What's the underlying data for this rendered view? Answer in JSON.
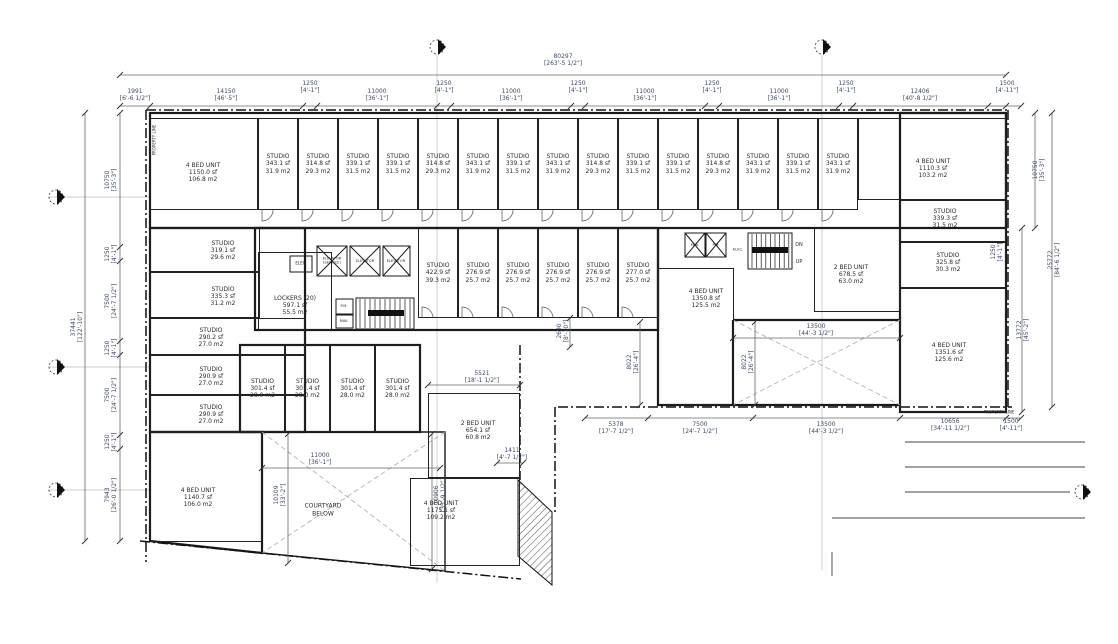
{
  "drawing": {
    "type": "architectural-floor-plan",
    "colors": {
      "wall": "#1a1a1a",
      "dim_text": "#3d4a63",
      "room_text": "#2b2b2b",
      "background": "#ffffff",
      "hatch": "#555555"
    }
  },
  "rooms": [
    {
      "n": "4 BED UNIT",
      "sf": "1150.0 sf",
      "m2": "106.8 m2",
      "x": 150,
      "y": 118,
      "w": 108,
      "h": 92,
      "lx": 202,
      "ly": 172
    },
    {
      "n": "STUDIO",
      "sf": "343.1 sf",
      "m2": "31.9 m2",
      "x": 258,
      "y": 118,
      "w": 40,
      "h": 92
    },
    {
      "n": "STUDIO",
      "sf": "314.8 sf",
      "m2": "29.3 m2",
      "x": 298,
      "y": 118,
      "w": 40,
      "h": 92
    },
    {
      "n": "STUDIO",
      "sf": "339.1 sf",
      "m2": "31.5 m2",
      "x": 338,
      "y": 118,
      "w": 40,
      "h": 92
    },
    {
      "n": "STUDIO",
      "sf": "339.1 sf",
      "m2": "31.5 m2",
      "x": 378,
      "y": 118,
      "w": 40,
      "h": 92
    },
    {
      "n": "STUDIO",
      "sf": "314.8 sf",
      "m2": "29.3 m2",
      "x": 418,
      "y": 118,
      "w": 40,
      "h": 92
    },
    {
      "n": "STUDIO",
      "sf": "343.1 sf",
      "m2": "31.9 m2",
      "x": 458,
      "y": 118,
      "w": 40,
      "h": 92
    },
    {
      "n": "STUDIO",
      "sf": "339.1 sf",
      "m2": "31.5 m2",
      "x": 498,
      "y": 118,
      "w": 40,
      "h": 92
    },
    {
      "n": "STUDIO",
      "sf": "343.1 sf",
      "m2": "31.9 m2",
      "x": 538,
      "y": 118,
      "w": 40,
      "h": 92
    },
    {
      "n": "STUDIO",
      "sf": "314.8 sf",
      "m2": "29.3 m2",
      "x": 578,
      "y": 118,
      "w": 40,
      "h": 92
    },
    {
      "n": "STUDIO",
      "sf": "339.1 sf",
      "m2": "31.5 m2",
      "x": 618,
      "y": 118,
      "w": 40,
      "h": 92
    },
    {
      "n": "STUDIO",
      "sf": "339.1 sf",
      "m2": "31.5 m2",
      "x": 658,
      "y": 118,
      "w": 40,
      "h": 92
    },
    {
      "n": "STUDIO",
      "sf": "314.8 sf",
      "m2": "29.3 m2",
      "x": 698,
      "y": 118,
      "w": 40,
      "h": 92
    },
    {
      "n": "STUDIO",
      "sf": "343.1 sf",
      "m2": "31.9 m2",
      "x": 738,
      "y": 118,
      "w": 40,
      "h": 92
    },
    {
      "n": "STUDIO",
      "sf": "339.1 sf",
      "m2": "31.5 m2",
      "x": 778,
      "y": 118,
      "w": 40,
      "h": 92
    },
    {
      "n": "STUDIO",
      "sf": "343.1 sf",
      "m2": "31.9 m2",
      "x": 818,
      "y": 118,
      "w": 40,
      "h": 92
    },
    {
      "n": "4 BED UNIT",
      "sf": "1110.3 sf",
      "m2": "103.2 m2",
      "x": 858,
      "y": 118,
      "w": 148,
      "h": 82,
      "lx": 932,
      "ly": 168
    },
    {
      "n": "STUDIO",
      "sf": "319.1 sf",
      "m2": "29.6 m2",
      "x": 150,
      "y": 228,
      "w": 110,
      "h": 44,
      "lx": 222,
      "ly": 250
    },
    {
      "n": "STUDIO",
      "sf": "335.3 sf",
      "m2": "31.2 m2",
      "x": 150,
      "y": 272,
      "w": 110,
      "h": 46,
      "lx": 222,
      "ly": 296
    },
    {
      "n": "STUDIO",
      "sf": "290.2 sf",
      "m2": "27.0 m2",
      "x": 150,
      "y": 318,
      "w": 155,
      "h": 37,
      "lx": 210,
      "ly": 337
    },
    {
      "n": "STUDIO",
      "sf": "290.9 sf",
      "m2": "27.0 m2",
      "x": 150,
      "y": 355,
      "w": 155,
      "h": 40,
      "lx": 210,
      "ly": 376
    },
    {
      "n": "STUDIO",
      "sf": "290.9 sf",
      "m2": "27.0 m2",
      "x": 150,
      "y": 395,
      "w": 155,
      "h": 37,
      "lx": 210,
      "ly": 414
    },
    {
      "n": "4 BED UNIT",
      "sf": "1140.7 sf",
      "m2": "106.0 m2",
      "x": 150,
      "y": 432,
      "w": 112,
      "h": 110,
      "lx": 197,
      "ly": 497
    },
    {
      "n": "LOCKERS (20)",
      "sf": "597.1 sf",
      "m2": "55.5 m2",
      "x": 258,
      "y": 252,
      "w": 74,
      "h": 78,
      "lx": 294,
      "ly": 305
    },
    {
      "n": "STUDIO",
      "sf": "422.9 sf",
      "m2": "39.3 m2",
      "x": 418,
      "y": 228,
      "w": 40,
      "h": 90
    },
    {
      "n": "STUDIO",
      "sf": "276.9 sf",
      "m2": "25.7 m2",
      "x": 458,
      "y": 228,
      "w": 40,
      "h": 90
    },
    {
      "n": "STUDIO",
      "sf": "276.9 sf",
      "m2": "25.7 m2",
      "x": 498,
      "y": 228,
      "w": 40,
      "h": 90
    },
    {
      "n": "STUDIO",
      "sf": "276.9 sf",
      "m2": "25.7 m2",
      "x": 538,
      "y": 228,
      "w": 40,
      "h": 90
    },
    {
      "n": "STUDIO",
      "sf": "276.9 sf",
      "m2": "25.7 m2",
      "x": 578,
      "y": 228,
      "w": 40,
      "h": 90
    },
    {
      "n": "STUDIO",
      "sf": "277.0 sf",
      "m2": "25.7 m2",
      "x": 618,
      "y": 228,
      "w": 40,
      "h": 90
    },
    {
      "n": "4 BED UNIT",
      "sf": "1350.8 sf",
      "m2": "125.5 m2",
      "x": 658,
      "y": 268,
      "w": 76,
      "h": 137,
      "lx": 705,
      "ly": 298
    },
    {
      "n": "2 BED UNIT",
      "sf": "678.5 sf",
      "m2": "63.0 m2",
      "x": 814,
      "y": 228,
      "w": 86,
      "h": 84,
      "lx": 850,
      "ly": 274
    },
    {
      "n": "STUDIO",
      "sf": "339.3 sf",
      "m2": "31.5 m2",
      "x": 900,
      "y": 200,
      "w": 106,
      "h": 42,
      "lx": 944,
      "ly": 218
    },
    {
      "n": "STUDIO",
      "sf": "325.8 sf",
      "m2": "30.3 m2",
      "x": 900,
      "y": 242,
      "w": 106,
      "h": 46,
      "lx": 947,
      "ly": 262
    },
    {
      "n": "4 BED UNIT",
      "sf": "1351.6 sf",
      "m2": "125.6 m2",
      "x": 900,
      "y": 288,
      "w": 106,
      "h": 124,
      "lx": 948,
      "ly": 352
    },
    {
      "n": "STUDIO",
      "sf": "301.4 sf",
      "m2": "28.0 m2",
      "x": 240,
      "y": 345,
      "w": 45,
      "h": 87
    },
    {
      "n": "STUDIO",
      "sf": "301.4 sf",
      "m2": "28.0 m2",
      "x": 285,
      "y": 345,
      "w": 45,
      "h": 87
    },
    {
      "n": "STUDIO",
      "sf": "301.4 sf",
      "m2": "28.0 m2",
      "x": 330,
      "y": 345,
      "w": 45,
      "h": 87
    },
    {
      "n": "STUDIO",
      "sf": "301.4 sf",
      "m2": "28.0 m2",
      "x": 375,
      "y": 345,
      "w": 45,
      "h": 87
    },
    {
      "n": "2 BED UNIT",
      "sf": "654.1 sf",
      "m2": "60.8 m2",
      "x": 428,
      "y": 393,
      "w": 92,
      "h": 85,
      "lx": 477,
      "ly": 430
    },
    {
      "n": "4 BED UNIT",
      "sf": "1175.1 sf",
      "m2": "109.2 m2",
      "x": 410,
      "y": 478,
      "w": 110,
      "h": 88,
      "lx": 440,
      "ly": 510
    }
  ],
  "dimensions": [
    {
      "v": "80297",
      "i": "[263'-5 1/2\"]",
      "x": 563,
      "y": 61,
      "r": 0
    },
    {
      "v": "1991",
      "i": "[6'-6 1/2\"]",
      "x": 135,
      "y": 96,
      "r": 0
    },
    {
      "v": "14150",
      "i": "[46'-5\"]",
      "x": 226,
      "y": 96,
      "r": 0
    },
    {
      "v": "1250",
      "i": "[4'-1\"]",
      "x": 310,
      "y": 88,
      "r": 0
    },
    {
      "v": "11000",
      "i": "[36'-1\"]",
      "x": 377,
      "y": 96,
      "r": 0
    },
    {
      "v": "1250",
      "i": "[4'-1\"]",
      "x": 444,
      "y": 88,
      "r": 0
    },
    {
      "v": "11000",
      "i": "[36'-1\"]",
      "x": 511,
      "y": 96,
      "r": 0
    },
    {
      "v": "1250",
      "i": "[4'-1\"]",
      "x": 578,
      "y": 88,
      "r": 0
    },
    {
      "v": "11000",
      "i": "[36'-1\"]",
      "x": 645,
      "y": 96,
      "r": 0
    },
    {
      "v": "1250",
      "i": "[4'-1\"]",
      "x": 712,
      "y": 88,
      "r": 0
    },
    {
      "v": "11000",
      "i": "[36'-1\"]",
      "x": 779,
      "y": 96,
      "r": 0
    },
    {
      "v": "1250",
      "i": "[4'-1\"]",
      "x": 846,
      "y": 88,
      "r": 0
    },
    {
      "v": "12406",
      "i": "[40'-8 1/2\"]",
      "x": 920,
      "y": 96,
      "r": 0
    },
    {
      "v": "1500",
      "i": "[4'-11\"]",
      "x": 1007,
      "y": 88,
      "r": 0
    },
    {
      "v": "37441",
      "i": "[122'-10\"]",
      "x": 78,
      "y": 327,
      "r": -90
    },
    {
      "v": "10750",
      "i": "[35'-3\"]",
      "x": 112,
      "y": 180,
      "r": -90
    },
    {
      "v": "1250",
      "i": "[4'-1\"]",
      "x": 112,
      "y": 254,
      "r": -90
    },
    {
      "v": "7500",
      "i": "[24'-7 1/2\"]",
      "x": 112,
      "y": 301,
      "r": -90
    },
    {
      "v": "1250",
      "i": "[4'-1\"]",
      "x": 112,
      "y": 348,
      "r": -90
    },
    {
      "v": "7500",
      "i": "[24'-7 1/2\"]",
      "x": 112,
      "y": 395,
      "r": -90
    },
    {
      "v": "1250",
      "i": "[4'-1\"]",
      "x": 112,
      "y": 442,
      "r": -90
    },
    {
      "v": "7943",
      "i": "[26'-0 1/2\"]",
      "x": 112,
      "y": 495,
      "r": -90
    },
    {
      "v": "10750",
      "i": "[35'-3\"]",
      "x": 1040,
      "y": 170,
      "r": -90
    },
    {
      "v": "1250",
      "i": "[4'-1\"]",
      "x": 998,
      "y": 252,
      "r": -90
    },
    {
      "v": "25772",
      "i": "[84'-6 1/2\"]",
      "x": 1055,
      "y": 260,
      "r": -90
    },
    {
      "v": "13772",
      "i": "[45'-2\"]",
      "x": 1024,
      "y": 330,
      "r": -90
    },
    {
      "v": "5378",
      "i": "[17'-7 1/2\"]",
      "x": 616,
      "y": 429,
      "r": 0
    },
    {
      "v": "7500",
      "i": "[24'-7 1/2\"]",
      "x": 700,
      "y": 429,
      "r": 0
    },
    {
      "v": "13500",
      "i": "[44'-3 1/2\"]",
      "x": 826,
      "y": 429,
      "r": 0
    },
    {
      "v": "10656",
      "i": "[34'-11 1/2\"]",
      "x": 950,
      "y": 426,
      "r": 0
    },
    {
      "v": "1500",
      "i": "[4'-11\"]",
      "x": 1011,
      "y": 426,
      "r": 0
    },
    {
      "v": "13500",
      "i": "[44'-3 1/2\"]",
      "x": 816,
      "y": 331,
      "r": 0
    },
    {
      "v": "8022",
      "i": "[26'-4\"]",
      "x": 634,
      "y": 362,
      "r": -90
    },
    {
      "v": "8022",
      "i": "[26'-4\"]",
      "x": 749,
      "y": 362,
      "r": -90
    },
    {
      "v": "2690",
      "i": "[8'-10\"]",
      "x": 564,
      "y": 331,
      "r": -90
    },
    {
      "v": "5521",
      "i": "[18'-1 1/2\"]",
      "x": 482,
      "y": 378,
      "r": 0
    },
    {
      "v": "1411",
      "i": "[4'-7 1/2\"]",
      "x": 512,
      "y": 455,
      "r": 0
    },
    {
      "v": "11000",
      "i": "[36'-1\"]",
      "x": 320,
      "y": 460,
      "r": 0
    },
    {
      "v": "10109",
      "i": "[33'-2\"]",
      "x": 281,
      "y": 495,
      "r": -90
    },
    {
      "v": "10906",
      "i": "[35'-9 1/2\"]",
      "x": 441,
      "y": 495,
      "r": -90
    }
  ],
  "labels": [
    {
      "name": "elevator-service-label",
      "lines": [
        "ELEVATOR",
        "(SERVICE)"
      ],
      "x": 332,
      "y": 261,
      "s": 3.6
    },
    {
      "name": "elevator-label",
      "lines": [
        "ELEVATOR"
      ],
      "x": 365,
      "y": 261,
      "s": 3.6
    },
    {
      "name": "elevator-label",
      "lines": [
        "ELEVATOR"
      ],
      "x": 396,
      "y": 261,
      "s": 3.6
    },
    {
      "name": "elec-label",
      "lines": [
        "ELEC."
      ],
      "x": 301,
      "y": 263,
      "s": 4
    },
    {
      "name": "pm-label",
      "lines": [
        "P.M."
      ],
      "x": 344,
      "y": 306,
      "s": 3.6
    },
    {
      "name": "mail-label",
      "lines": [
        "MAIL"
      ],
      "x": 344,
      "y": 321,
      "s": 3.6
    },
    {
      "name": "mail-label",
      "lines": [
        "MAIL"
      ],
      "x": 695,
      "y": 245,
      "s": 3.6
    },
    {
      "name": "pm-label",
      "lines": [
        "P.M."
      ],
      "x": 716,
      "y": 245,
      "s": 3.6
    },
    {
      "name": "elec-label",
      "lines": [
        "ELEC."
      ],
      "x": 738,
      "y": 250,
      "s": 3.8
    },
    {
      "name": "stair-dn-label",
      "lines": [
        "DN"
      ],
      "x": 799,
      "y": 245,
      "s": 5
    },
    {
      "name": "stair-up-label",
      "lines": [
        "UP"
      ],
      "x": 799,
      "y": 262,
      "s": 5
    },
    {
      "name": "courtyard-label",
      "lines": [
        "COURTYARD",
        "BELOW"
      ],
      "x": 323,
      "y": 510,
      "s": 6
    },
    {
      "name": "property-line-label",
      "lines": [
        "PROPERTY LINE"
      ],
      "x": 154,
      "y": 140,
      "s": 4,
      "r": -90
    },
    {
      "name": "property-line-label",
      "lines": [
        "PROPERTY LINE"
      ],
      "x": 999,
      "y": 412,
      "s": 4
    }
  ],
  "section_markers": [
    {
      "x": 437,
      "y": 47
    },
    {
      "x": 822,
      "y": 47
    },
    {
      "x": 56,
      "y": 197
    },
    {
      "x": 56,
      "y": 367
    },
    {
      "x": 56,
      "y": 490
    },
    {
      "x": 1082,
      "y": 492
    }
  ]
}
